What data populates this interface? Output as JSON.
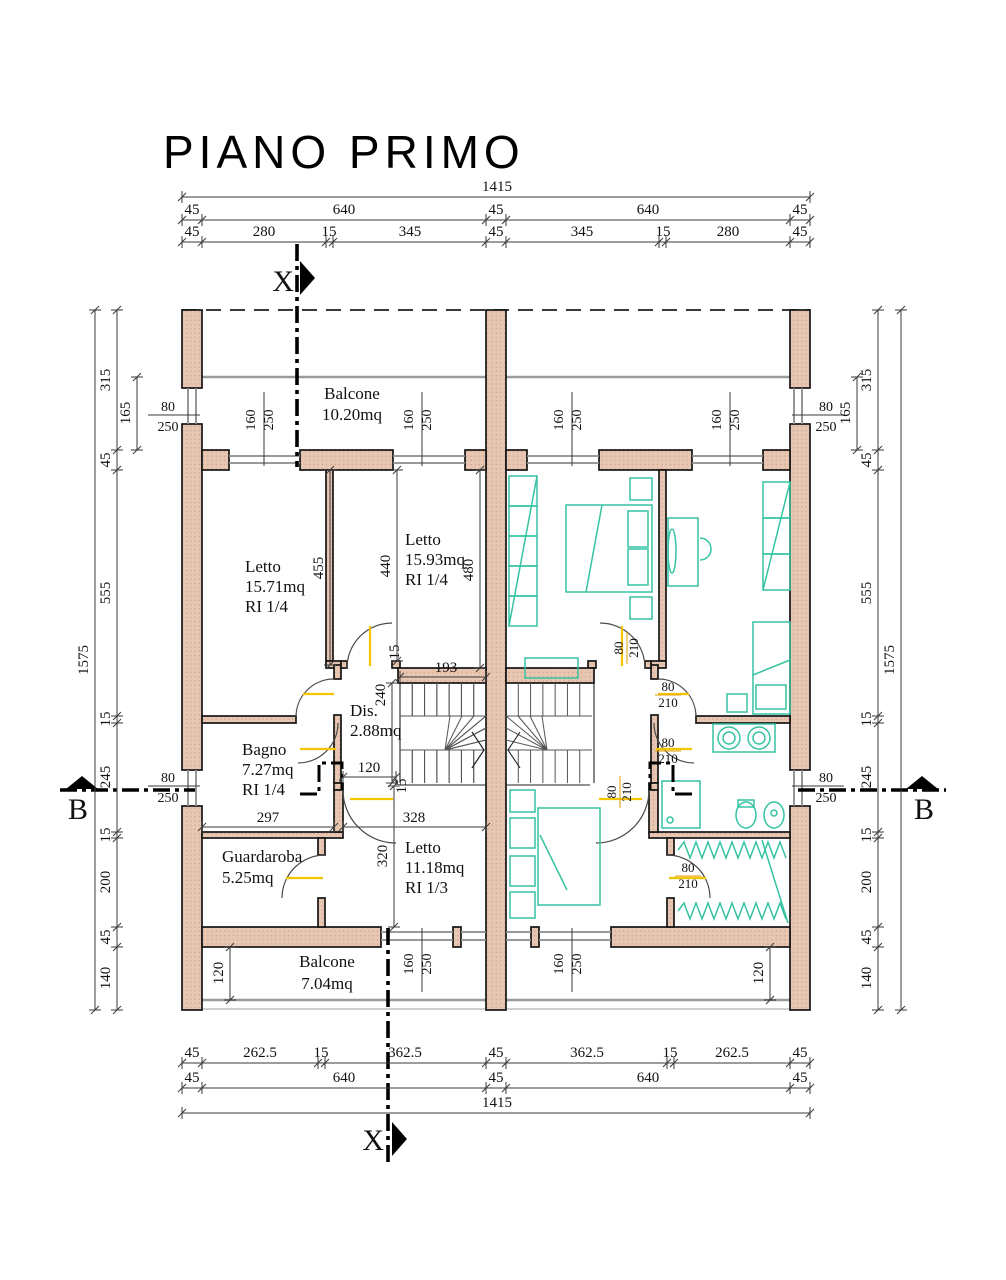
{
  "title": "PIANO PRIMO",
  "sections": {
    "x": "X",
    "x2": "X",
    "b": "B",
    "b2": "B"
  },
  "dims_top": {
    "total": "1415",
    "row2": [
      "45",
      "640",
      "45",
      "640",
      "45"
    ],
    "row3": [
      "45",
      "280",
      "15",
      "345",
      "45",
      "345",
      "15",
      "280",
      "45"
    ]
  },
  "dims_bottom": {
    "row1": [
      "45",
      "262.5",
      "15",
      "362.5",
      "45",
      "362.5",
      "15",
      "262.5",
      "45"
    ],
    "row2": [
      "45",
      "640",
      "45",
      "640",
      "45"
    ],
    "total": "1415"
  },
  "dims_left": {
    "total": "1575",
    "chain": [
      "315",
      "45",
      "555",
      "15",
      "245",
      "15",
      "200",
      "45",
      "140"
    ],
    "aux": "165"
  },
  "dims_right": {
    "total": "1575",
    "chain": [
      "315",
      "45",
      "555",
      "15",
      "245",
      "15",
      "200",
      "45",
      "140"
    ],
    "aux": "165"
  },
  "rooms": {
    "balcone_top": {
      "name": "Balcone",
      "area": "10.20mq"
    },
    "letto_a": {
      "name": "Letto",
      "area": "15.71mq",
      "ri": "RI 1/4"
    },
    "letto_b": {
      "name": "Letto",
      "area": "15.93mq",
      "ri": "RI 1/4"
    },
    "dis": {
      "name": "Dis.",
      "area": "2.88mq"
    },
    "bagno": {
      "name": "Bagno",
      "area": "7.27mq",
      "ri": "RI 1/4"
    },
    "guardaroba": {
      "name": "Guardaroba",
      "area": "5.25mq"
    },
    "letto_c": {
      "name": "Letto",
      "area": "11.18mq",
      "ri": "RI 1/3"
    },
    "balcone_bottom": {
      "name": "Balcone",
      "area": "7.04mq"
    }
  },
  "interior_dims": {
    "partition_a": "455",
    "letto_b_depth": "440",
    "letto_b_right": "480",
    "stair_top": "15",
    "stair_width": "193",
    "dis_depth": "240",
    "dis_door": "120",
    "bagno_width": "297",
    "letto_c_width": "328",
    "letto_c_wall": "15",
    "letto_c_depth": "320",
    "balcony_depth_left": "120",
    "balcony_depth_right": "120"
  },
  "openings": {
    "window_w": "160",
    "window_h": "250",
    "side_window_w": "80",
    "side_window_h": "250",
    "door_w": "80",
    "door_h": "210"
  },
  "colors": {
    "wall": "#e8c7b2",
    "walldot": "#cfa68d",
    "furniture": "#35c3a2",
    "leaf": "#f5c400",
    "dlab": "#e09e00",
    "line": "#141414",
    "dim": "#3a3a3a"
  }
}
